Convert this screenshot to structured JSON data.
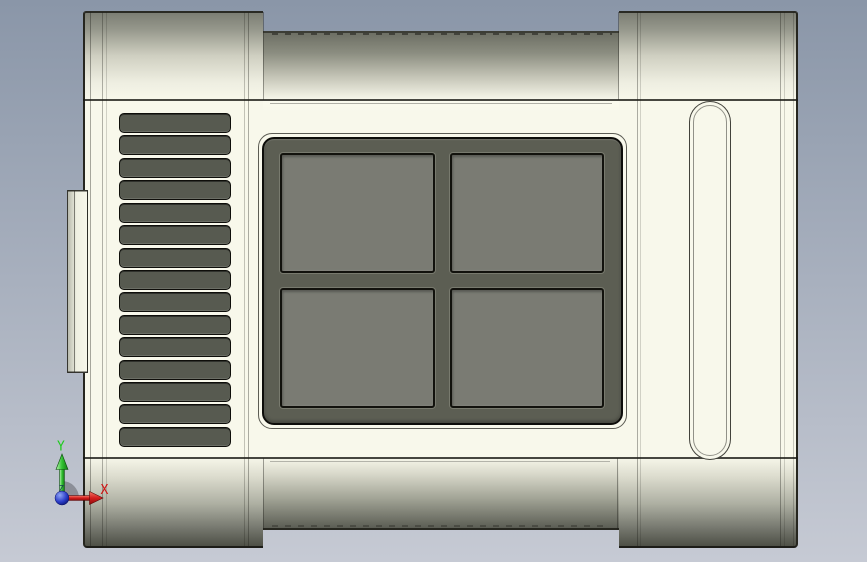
{
  "viewport": {
    "description": "CAD orthographic front view of enclosure part",
    "view_orientation": "front"
  },
  "triad": {
    "labels": {
      "x": "X",
      "y": "Y",
      "z": "Z"
    }
  },
  "model": {
    "vents": {
      "count": 15
    },
    "window": {
      "rows": 2,
      "cols": 2,
      "pane_count": 4
    },
    "features": {
      "vent_grille": "louvered vent panel",
      "window": "four-pane recessed window",
      "rib": "vertical rounded slot rib",
      "tab": "left side flange tab"
    }
  },
  "colors": {
    "bgTop": "#8a96a8",
    "bgBottom": "#c6cad4",
    "body": "#f8f8eb",
    "shadeBottom": "#4e5046",
    "panelDark": "#5c5e53",
    "pane": "#7a7b73",
    "slat": "#575a50",
    "edge": "#1d1d18",
    "axisX": "#d11313",
    "axisY": "#1ecb1e",
    "axisZ": "#16424e",
    "originBlue": "#2436c8"
  }
}
